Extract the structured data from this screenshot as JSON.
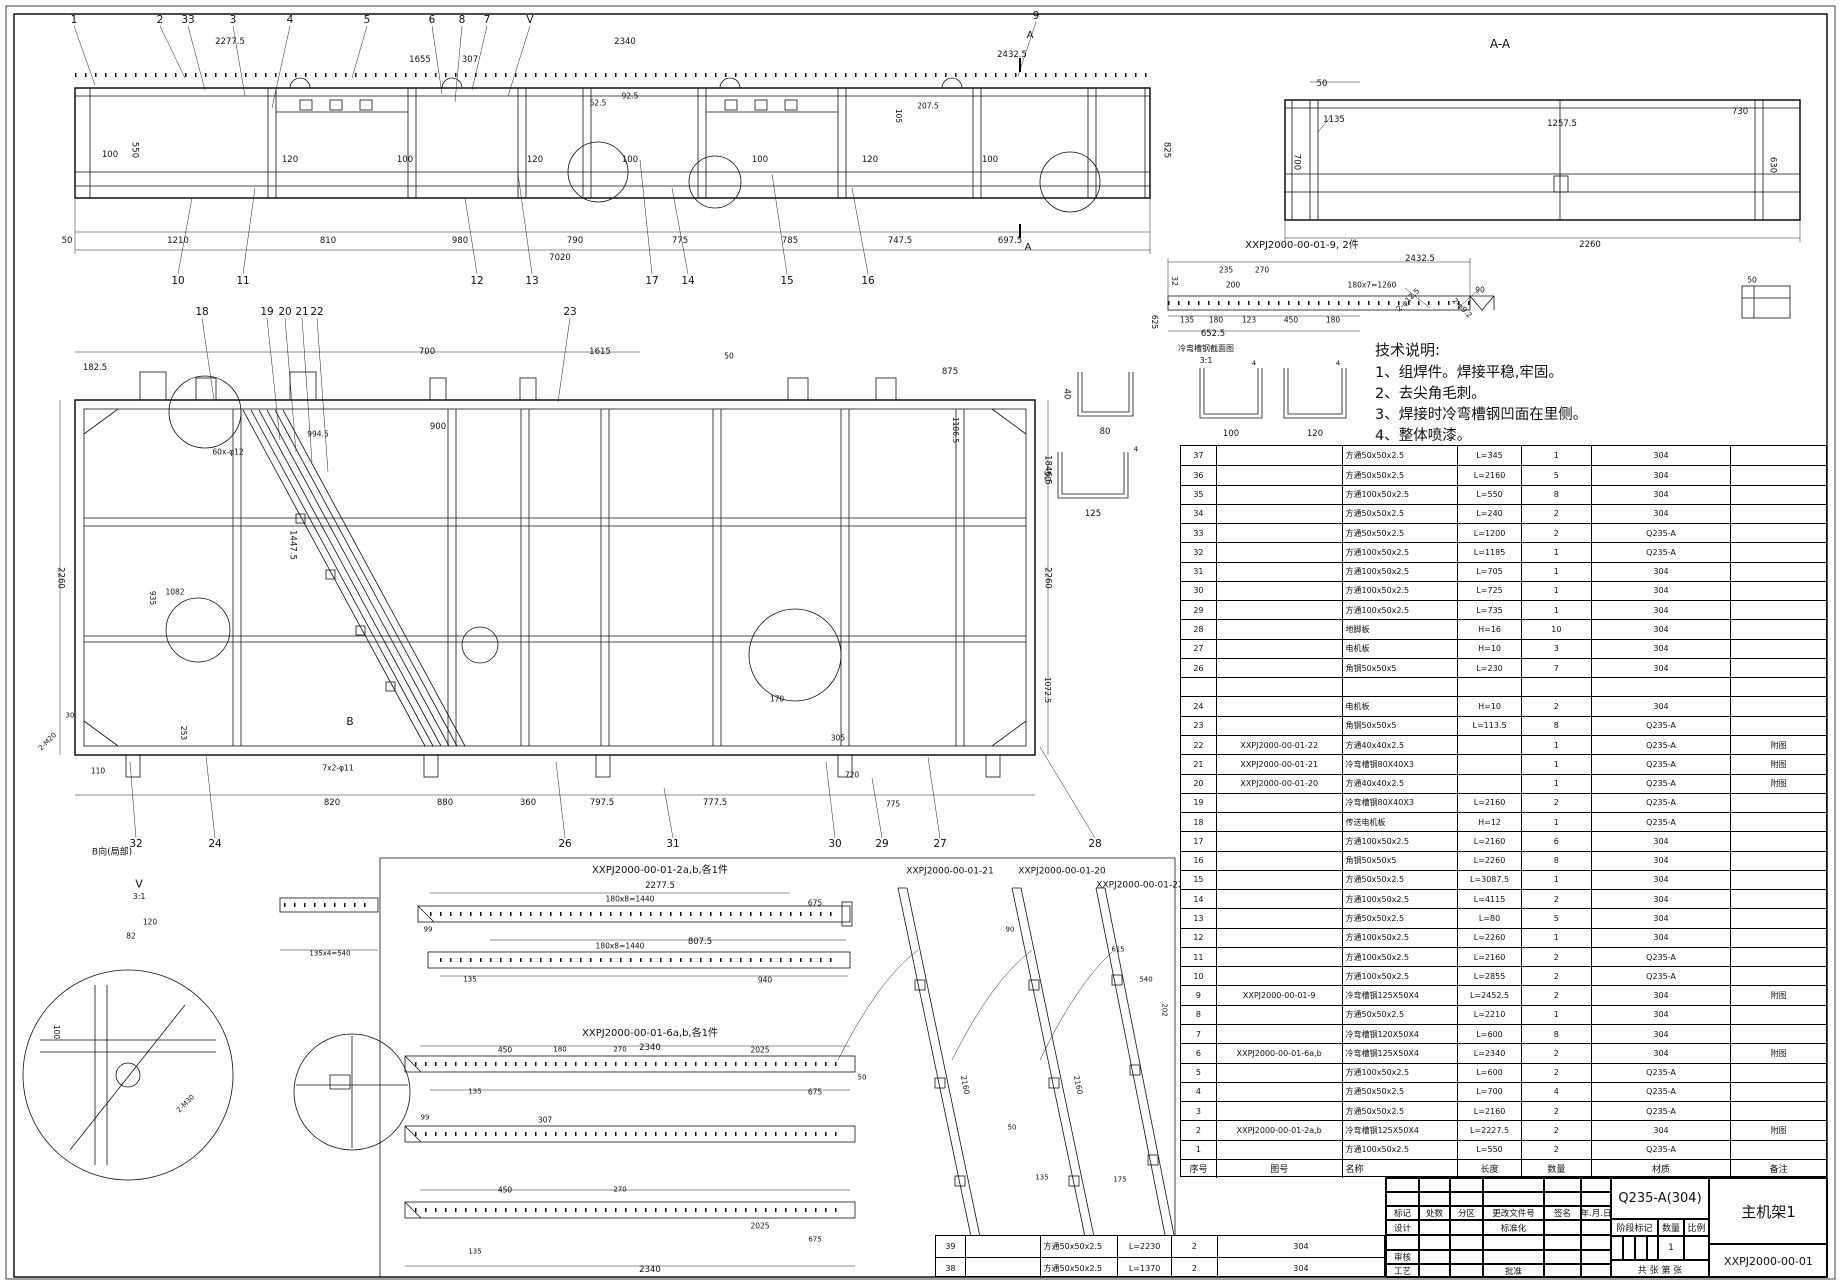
{
  "sheet": {
    "background": "#ffffff",
    "line_color": "#000000"
  },
  "tech_notes": {
    "title": "技术说明:",
    "items": [
      "1、组焊件。焊接平稳,牢固。",
      "2、去尖角毛刺。",
      "3、焊接时冷弯槽钢凹面在里侧。",
      "4、整体喷漆。"
    ]
  },
  "bom": {
    "headers": [
      "序号",
      "图号",
      "名称",
      "长度",
      "数量",
      "材质",
      "备注"
    ],
    "rows": [
      [
        "37",
        "",
        "方通50x50x2.5",
        "L=345",
        "1",
        "304",
        ""
      ],
      [
        "36",
        "",
        "方通50x50x2.5",
        "L=2160",
        "5",
        "304",
        ""
      ],
      [
        "35",
        "",
        "方通100x50x2.5",
        "L=550",
        "8",
        "304",
        ""
      ],
      [
        "34",
        "",
        "方通50x50x2.5",
        "L=240",
        "2",
        "304",
        ""
      ],
      [
        "33",
        "",
        "方通50x50x2.5",
        "L=1200",
        "2",
        "Q235-A",
        ""
      ],
      [
        "32",
        "",
        "方通100x50x2.5",
        "L=1185",
        "1",
        "Q235-A",
        ""
      ],
      [
        "31",
        "",
        "方通100x50x2.5",
        "L=705",
        "1",
        "304",
        ""
      ],
      [
        "30",
        "",
        "方通100x50x2.5",
        "L=725",
        "1",
        "304",
        ""
      ],
      [
        "29",
        "",
        "方通100x50x2.5",
        "L=735",
        "1",
        "304",
        ""
      ],
      [
        "28",
        "",
        "地脚板",
        "H=16",
        "10",
        "304",
        ""
      ],
      [
        "27",
        "",
        "电机板",
        "H=10",
        "3",
        "304",
        ""
      ],
      [
        "26",
        "",
        "角钢50x50x5",
        "L=230",
        "7",
        "304",
        ""
      ],
      [
        "",
        "",
        "",
        "",
        "",
        "",
        ""
      ],
      [
        "24",
        "",
        "电机板",
        "H=10",
        "2",
        "304",
        ""
      ],
      [
        "23",
        "",
        "角钢50x50x5",
        "L=113.5",
        "8",
        "Q235-A",
        ""
      ],
      [
        "22",
        "XXPJ2000-00-01-22",
        "方通40x40x2.5",
        "",
        "1",
        "Q235-A",
        "附图"
      ],
      [
        "21",
        "XXPJ2000-00-01-21",
        "冷弯槽钢80X40X3",
        "",
        "1",
        "Q235-A",
        "附图"
      ],
      [
        "20",
        "XXPJ2000-00-01-20",
        "方通40x40x2.5",
        "",
        "1",
        "Q235-A",
        "附图"
      ],
      [
        "19",
        "",
        "冷弯槽钢80X40X3",
        "L=2160",
        "2",
        "Q235-A",
        ""
      ],
      [
        "18",
        "",
        "传送电机板",
        "H=12",
        "1",
        "Q235-A",
        ""
      ],
      [
        "17",
        "",
        "方通100x50x2.5",
        "L=2160",
        "6",
        "304",
        ""
      ],
      [
        "16",
        "",
        "角钢50x50x5",
        "L=2260",
        "8",
        "304",
        ""
      ],
      [
        "15",
        "",
        "方通50x50x2.5",
        "L=3087.5",
        "1",
        "304",
        ""
      ],
      [
        "14",
        "",
        "方通100x50x2.5",
        "L=4115",
        "2",
        "304",
        ""
      ],
      [
        "13",
        "",
        "方通50x50x2.5",
        "L=80",
        "5",
        "304",
        ""
      ],
      [
        "12",
        "",
        "方通100x50x2.5",
        "L=2260",
        "1",
        "304",
        ""
      ],
      [
        "11",
        "",
        "方通100x50x2.5",
        "L=2160",
        "2",
        "Q235-A",
        ""
      ],
      [
        "10",
        "",
        "方通100x50x2.5",
        "L=2855",
        "2",
        "Q235-A",
        ""
      ],
      [
        "9",
        "XXPJ2000-00-01-9",
        "冷弯槽钢125X50X4",
        "L=2452.5",
        "2",
        "304",
        "附图"
      ],
      [
        "8",
        "",
        "方通50x50x2.5",
        "L=2210",
        "1",
        "304",
        ""
      ],
      [
        "7",
        "",
        "冷弯槽钢120X50X4",
        "L=600",
        "8",
        "304",
        ""
      ],
      [
        "6",
        "XXPJ2000-00-01-6a,b",
        "冷弯槽钢125X50X4",
        "L=2340",
        "2",
        "304",
        "附图"
      ],
      [
        "5",
        "",
        "方通100x50x2.5",
        "L=600",
        "2",
        "Q235-A",
        ""
      ],
      [
        "4",
        "",
        "方通50x50x2.5",
        "L=700",
        "4",
        "Q235-A",
        ""
      ],
      [
        "3",
        "",
        "方通50x50x2.5",
        "L=2160",
        "2",
        "Q235-A",
        ""
      ],
      [
        "2",
        "XXPJ2000-00-01-2a,b",
        "冷弯槽钢125X50X4",
        "L=2227.5",
        "2",
        "304",
        "附图"
      ],
      [
        "1",
        "",
        "方通100x50x2.5",
        "L=550",
        "2",
        "Q235-A",
        ""
      ]
    ]
  },
  "extra_rows": [
    [
      "39",
      "",
      "方通50x50x2.5",
      "L=2230",
      "2",
      "304"
    ],
    [
      "38",
      "",
      "方通50x50x2.5",
      "L=1370",
      "2",
      "304"
    ]
  ],
  "title_block": {
    "material": "Q235-A(304)",
    "part_name": "主机架1",
    "drawing_number": "XXPJ2000-00-01",
    "revision_headers": [
      "标记",
      "处数",
      "分区",
      "更改文件号",
      "签名",
      "年.月.日"
    ],
    "row_design": "设计",
    "row_standard": "标准化",
    "row_check": "审核",
    "row_process": "工艺",
    "row_approve": "批准",
    "stage_label": "阶段标记",
    "qty_label": "数量",
    "scale_label": "比例",
    "qty_value": "1",
    "sheet_note": "共  张  第  张"
  },
  "annotations": [
    {
      "t": "1",
      "x": 74,
      "y": 20,
      "k": "b"
    },
    {
      "t": "2",
      "x": 160,
      "y": 20,
      "k": "b"
    },
    {
      "t": "33",
      "x": 188,
      "y": 20,
      "k": "b"
    },
    {
      "t": "3",
      "x": 233,
      "y": 20,
      "k": "b"
    },
    {
      "t": "4",
      "x": 290,
      "y": 20,
      "k": "b"
    },
    {
      "t": "5",
      "x": 367,
      "y": 20,
      "k": "b"
    },
    {
      "t": "6",
      "x": 432,
      "y": 20,
      "k": "b"
    },
    {
      "t": "8",
      "x": 462,
      "y": 20,
      "k": "b"
    },
    {
      "t": "7",
      "x": 487,
      "y": 20,
      "k": "b"
    },
    {
      "t": "V",
      "x": 530,
      "y": 20,
      "k": "b"
    },
    {
      "t": "9",
      "x": 1036,
      "y": 16,
      "k": "b"
    },
    {
      "t": "A",
      "x": 1030,
      "y": 36,
      "k": "t"
    },
    {
      "t": "2277.5",
      "x": 230,
      "y": 42
    },
    {
      "t": "1655",
      "x": 420,
      "y": 60
    },
    {
      "t": "307",
      "x": 470,
      "y": 60
    },
    {
      "t": "2340",
      "x": 625,
      "y": 42
    },
    {
      "t": "2432.5",
      "x": 1012,
      "y": 55
    },
    {
      "t": "52.5",
      "x": 598,
      "y": 103,
      "s": 7.5
    },
    {
      "t": "92.5",
      "x": 630,
      "y": 96,
      "s": 7.5
    },
    {
      "t": "207.5",
      "x": 928,
      "y": 106,
      "s": 7.5
    },
    {
      "t": "105",
      "x": 898,
      "y": 116,
      "r": 90,
      "s": 7.5
    },
    {
      "t": "100",
      "x": 110,
      "y": 155
    },
    {
      "t": "550",
      "x": 134,
      "y": 150,
      "r": 90
    },
    {
      "t": "120",
      "x": 290,
      "y": 160
    },
    {
      "t": "100",
      "x": 405,
      "y": 160
    },
    {
      "t": "120",
      "x": 535,
      "y": 160
    },
    {
      "t": "100",
      "x": 630,
      "y": 160
    },
    {
      "t": "100",
      "x": 760,
      "y": 160
    },
    {
      "t": "120",
      "x": 870,
      "y": 160
    },
    {
      "t": "100",
      "x": 990,
      "y": 160
    },
    {
      "t": "825",
      "x": 1166,
      "y": 150,
      "r": 90
    },
    {
      "t": "50",
      "x": 67,
      "y": 241
    },
    {
      "t": "1210",
      "x": 178,
      "y": 241
    },
    {
      "t": "810",
      "x": 328,
      "y": 241
    },
    {
      "t": "980",
      "x": 460,
      "y": 241
    },
    {
      "t": "790",
      "x": 575,
      "y": 241
    },
    {
      "t": "775",
      "x": 680,
      "y": 241
    },
    {
      "t": "785",
      "x": 790,
      "y": 241
    },
    {
      "t": "747.5",
      "x": 900,
      "y": 241
    },
    {
      "t": "697.5",
      "x": 1010,
      "y": 241
    },
    {
      "t": "7020",
      "x": 560,
      "y": 258
    },
    {
      "t": "10",
      "x": 178,
      "y": 281,
      "k": "b"
    },
    {
      "t": "11",
      "x": 243,
      "y": 281,
      "k": "b"
    },
    {
      "t": "12",
      "x": 477,
      "y": 281,
      "k": "b"
    },
    {
      "t": "13",
      "x": 532,
      "y": 281,
      "k": "b"
    },
    {
      "t": "17",
      "x": 652,
      "y": 281,
      "k": "b"
    },
    {
      "t": "14",
      "x": 688,
      "y": 281,
      "k": "b"
    },
    {
      "t": "15",
      "x": 787,
      "y": 281,
      "k": "b"
    },
    {
      "t": "16",
      "x": 868,
      "y": 281,
      "k": "b"
    },
    {
      "t": "A",
      "x": 1028,
      "y": 248,
      "k": "t"
    },
    {
      "t": "A-A",
      "x": 1500,
      "y": 44,
      "k": "t",
      "s": 12
    },
    {
      "t": "50",
      "x": 1322,
      "y": 84
    },
    {
      "t": "1135",
      "x": 1334,
      "y": 120
    },
    {
      "t": "700",
      "x": 1296,
      "y": 162,
      "r": 90
    },
    {
      "t": "1257.5",
      "x": 1562,
      "y": 124
    },
    {
      "t": "730",
      "x": 1740,
      "y": 112
    },
    {
      "t": "630",
      "x": 1772,
      "y": 165,
      "r": 90
    },
    {
      "t": "2260",
      "x": 1590,
      "y": 245
    },
    {
      "t": "XXPJ2000-00-01-9, 2件",
      "x": 1302,
      "y": 246,
      "k": "t"
    },
    {
      "t": "2432.5",
      "x": 1420,
      "y": 259
    },
    {
      "t": "32",
      "x": 1174,
      "y": 281,
      "r": 90,
      "s": 7.5
    },
    {
      "t": "235",
      "x": 1226,
      "y": 270,
      "s": 7.5
    },
    {
      "t": "270",
      "x": 1262,
      "y": 270,
      "s": 7.5
    },
    {
      "t": "200",
      "x": 1233,
      "y": 285,
      "s": 7.5
    },
    {
      "t": "180x7=1260",
      "x": 1372,
      "y": 285,
      "s": 7.5
    },
    {
      "t": "90",
      "x": 1480,
      "y": 290,
      "s": 7.5
    },
    {
      "t": "625",
      "x": 1154,
      "y": 322,
      "r": 90,
      "s": 7.5
    },
    {
      "t": "135",
      "x": 1187,
      "y": 320,
      "s": 7.5
    },
    {
      "t": "180",
      "x": 1216,
      "y": 320,
      "s": 7.5
    },
    {
      "t": "123",
      "x": 1249,
      "y": 320,
      "s": 7.5
    },
    {
      "t": "450",
      "x": 1291,
      "y": 320,
      "s": 7.5
    },
    {
      "t": "180",
      "x": 1333,
      "y": 320,
      "s": 7.5
    },
    {
      "t": "652.5",
      "x": 1213,
      "y": 334
    },
    {
      "t": "2-φ12.5",
      "x": 1408,
      "y": 300,
      "r": -45,
      "s": 7.5
    },
    {
      "t": "2-φ9.2",
      "x": 1462,
      "y": 308,
      "r": 45,
      "s": 7.5
    },
    {
      "t": "50",
      "x": 1752,
      "y": 280,
      "s": 7.5
    },
    {
      "t": "冷弯槽钢截面图",
      "x": 1206,
      "y": 349,
      "k": "t",
      "s": 8
    },
    {
      "t": "3:1",
      "x": 1206,
      "y": 361,
      "k": "t",
      "s": 8
    },
    {
      "t": "80",
      "x": 1105,
      "y": 432
    },
    {
      "t": "40",
      "x": 1066,
      "y": 394,
      "r": 90
    },
    {
      "t": "100",
      "x": 1231,
      "y": 434
    },
    {
      "t": "120",
      "x": 1315,
      "y": 434
    },
    {
      "t": "4",
      "x": 1254,
      "y": 364,
      "s": 7
    },
    {
      "t": "4",
      "x": 1338,
      "y": 364,
      "s": 7
    },
    {
      "t": "125",
      "x": 1093,
      "y": 514
    },
    {
      "t": "50",
      "x": 1046,
      "y": 476,
      "r": 90
    },
    {
      "t": "4",
      "x": 1136,
      "y": 450,
      "s": 7
    },
    {
      "t": "18",
      "x": 202,
      "y": 312,
      "k": "b"
    },
    {
      "t": "19",
      "x": 267,
      "y": 312,
      "k": "b"
    },
    {
      "t": "20",
      "x": 285,
      "y": 312,
      "k": "b"
    },
    {
      "t": "21",
      "x": 302,
      "y": 312,
      "k": "b"
    },
    {
      "t": "22",
      "x": 317,
      "y": 312,
      "k": "b"
    },
    {
      "t": "23",
      "x": 570,
      "y": 312,
      "k": "b"
    },
    {
      "t": "182.5",
      "x": 95,
      "y": 368
    },
    {
      "t": "700",
      "x": 427,
      "y": 352
    },
    {
      "t": "50",
      "x": 729,
      "y": 356,
      "s": 7.5
    },
    {
      "t": "875",
      "x": 950,
      "y": 372
    },
    {
      "t": "1615",
      "x": 600,
      "y": 352
    },
    {
      "t": "994.5",
      "x": 318,
      "y": 434,
      "s": 7.5
    },
    {
      "t": "900",
      "x": 438,
      "y": 427
    },
    {
      "t": "60x-φ12",
      "x": 228,
      "y": 452,
      "s": 7.5
    },
    {
      "t": "1447.5",
      "x": 292,
      "y": 545,
      "r": 90
    },
    {
      "t": "1082",
      "x": 175,
      "y": 592,
      "s": 7.5
    },
    {
      "t": "935",
      "x": 152,
      "y": 598,
      "r": 90,
      "s": 7.5
    },
    {
      "t": "2260",
      "x": 60,
      "y": 578,
      "r": 90
    },
    {
      "t": "2260",
      "x": 1047,
      "y": 578,
      "r": 90
    },
    {
      "t": "1846.5",
      "x": 1047,
      "y": 470,
      "r": 90
    },
    {
      "t": "1072.5",
      "x": 1047,
      "y": 690,
      "r": 90,
      "s": 7.5
    },
    {
      "t": "1186.5",
      "x": 955,
      "y": 430,
      "r": 90,
      "s": 7.5
    },
    {
      "t": "B",
      "x": 350,
      "y": 722,
      "k": "b"
    },
    {
      "t": "110",
      "x": 98,
      "y": 771,
      "s": 7.5
    },
    {
      "t": "253",
      "x": 183,
      "y": 733,
      "r": 90,
      "s": 7.5
    },
    {
      "t": "2-M20",
      "x": 48,
      "y": 742,
      "r": -45,
      "s": 7
    },
    {
      "t": "30",
      "x": 70,
      "y": 716,
      "s": 7
    },
    {
      "t": "7x2-φ11",
      "x": 338,
      "y": 768,
      "s": 7.5
    },
    {
      "t": "820",
      "x": 332,
      "y": 803
    },
    {
      "t": "880",
      "x": 445,
      "y": 803
    },
    {
      "t": "360",
      "x": 528,
      "y": 803
    },
    {
      "t": "797.5",
      "x": 602,
      "y": 803
    },
    {
      "t": "777.5",
      "x": 715,
      "y": 803
    },
    {
      "t": "720",
      "x": 852,
      "y": 775,
      "s": 7.5
    },
    {
      "t": "775",
      "x": 893,
      "y": 804,
      "s": 7.5
    },
    {
      "t": "305",
      "x": 838,
      "y": 738,
      "s": 7.5
    },
    {
      "t": "170",
      "x": 777,
      "y": 699,
      "s": 7.5
    },
    {
      "t": "32",
      "x": 136,
      "y": 844,
      "k": "b"
    },
    {
      "t": "24",
      "x": 215,
      "y": 844,
      "k": "b"
    },
    {
      "t": "26",
      "x": 565,
      "y": 844,
      "k": "b"
    },
    {
      "t": "31",
      "x": 673,
      "y": 844,
      "k": "b"
    },
    {
      "t": "30",
      "x": 835,
      "y": 844,
      "k": "b"
    },
    {
      "t": "29",
      "x": 882,
      "y": 844,
      "k": "b"
    },
    {
      "t": "27",
      "x": 940,
      "y": 844,
      "k": "b"
    },
    {
      "t": "28",
      "x": 1095,
      "y": 844,
      "k": "b"
    },
    {
      "t": "V",
      "x": 139,
      "y": 884,
      "k": "t",
      "s": 11
    },
    {
      "t": "3:1",
      "x": 139,
      "y": 897,
      "k": "t",
      "s": 8
    },
    {
      "t": "B向(局部)",
      "x": 112,
      "y": 853,
      "k": "t",
      "s": 9
    },
    {
      "t": "120",
      "x": 150,
      "y": 922,
      "s": 7.5
    },
    {
      "t": "82",
      "x": 131,
      "y": 936,
      "s": 7.5
    },
    {
      "t": "100",
      "x": 56,
      "y": 1032,
      "r": 90,
      "s": 7.5
    },
    {
      "t": "2-M30",
      "x": 186,
      "y": 1104,
      "r": -45,
      "s": 7
    },
    {
      "t": "135x4=540",
      "x": 330,
      "y": 954,
      "s": 7
    },
    {
      "t": "XXPJ2000-00-01-2a,b,各1件",
      "x": 660,
      "y": 871,
      "k": "t"
    },
    {
      "t": "2277.5",
      "x": 660,
      "y": 886
    },
    {
      "t": "180x8=1440",
      "x": 630,
      "y": 899,
      "s": 7.5
    },
    {
      "t": "675",
      "x": 815,
      "y": 903,
      "s": 7.5
    },
    {
      "t": "99",
      "x": 428,
      "y": 930,
      "s": 7
    },
    {
      "t": "807.5",
      "x": 700,
      "y": 942
    },
    {
      "t": "180x8=1440",
      "x": 620,
      "y": 946,
      "s": 7.5
    },
    {
      "t": "940",
      "x": 765,
      "y": 980,
      "s": 7.5
    },
    {
      "t": "135",
      "x": 470,
      "y": 980,
      "s": 7
    },
    {
      "t": "XXPJ2000-00-01-6a,b,各1件",
      "x": 650,
      "y": 1034,
      "k": "t"
    },
    {
      "t": "2340",
      "x": 650,
      "y": 1048
    },
    {
      "t": "450",
      "x": 505,
      "y": 1050,
      "s": 7.5
    },
    {
      "t": "180",
      "x": 560,
      "y": 1050,
      "s": 7
    },
    {
      "t": "270",
      "x": 620,
      "y": 1050,
      "s": 7
    },
    {
      "t": "2025",
      "x": 760,
      "y": 1050,
      "s": 7.5
    },
    {
      "t": "135",
      "x": 475,
      "y": 1092,
      "s": 7
    },
    {
      "t": "675",
      "x": 815,
      "y": 1092,
      "s": 7.5
    },
    {
      "t": "50",
      "x": 862,
      "y": 1078,
      "s": 7
    },
    {
      "t": "307",
      "x": 545,
      "y": 1120,
      "s": 7.5
    },
    {
      "t": "99",
      "x": 425,
      "y": 1118,
      "s": 7
    },
    {
      "t": "450",
      "x": 505,
      "y": 1190,
      "s": 7.5
    },
    {
      "t": "270",
      "x": 620,
      "y": 1190,
      "s": 7
    },
    {
      "t": "2025",
      "x": 760,
      "y": 1226,
      "s": 7.5
    },
    {
      "t": "675",
      "x": 815,
      "y": 1240,
      "s": 7
    },
    {
      "t": "135",
      "x": 475,
      "y": 1252,
      "s": 7
    },
    {
      "t": "2340",
      "x": 650,
      "y": 1270
    },
    {
      "t": "XXPJ2000-00-01-21",
      "x": 950,
      "y": 872,
      "k": "t",
      "s": 9
    },
    {
      "t": "XXPJ2000-00-01-20",
      "x": 1062,
      "y": 872,
      "k": "t",
      "s": 9
    },
    {
      "t": "XXPJ2000-00-01-22",
      "x": 1140,
      "y": 886,
      "k": "t",
      "s": 9
    },
    {
      "t": "90",
      "x": 1010,
      "y": 930,
      "s": 7
    },
    {
      "t": "615",
      "x": 1118,
      "y": 950,
      "s": 7
    },
    {
      "t": "540",
      "x": 1146,
      "y": 980,
      "s": 7
    },
    {
      "t": "202",
      "x": 1164,
      "y": 1010,
      "r": 90,
      "s": 7
    },
    {
      "t": "2160",
      "x": 965,
      "y": 1085,
      "r": 78,
      "s": 7.5
    },
    {
      "t": "2160",
      "x": 1078,
      "y": 1085,
      "r": 78,
      "s": 7.5
    },
    {
      "t": "50",
      "x": 1012,
      "y": 1128,
      "s": 7
    },
    {
      "t": "135",
      "x": 1042,
      "y": 1178,
      "s": 7
    },
    {
      "t": "175",
      "x": 1120,
      "y": 1180,
      "s": 7
    }
  ]
}
